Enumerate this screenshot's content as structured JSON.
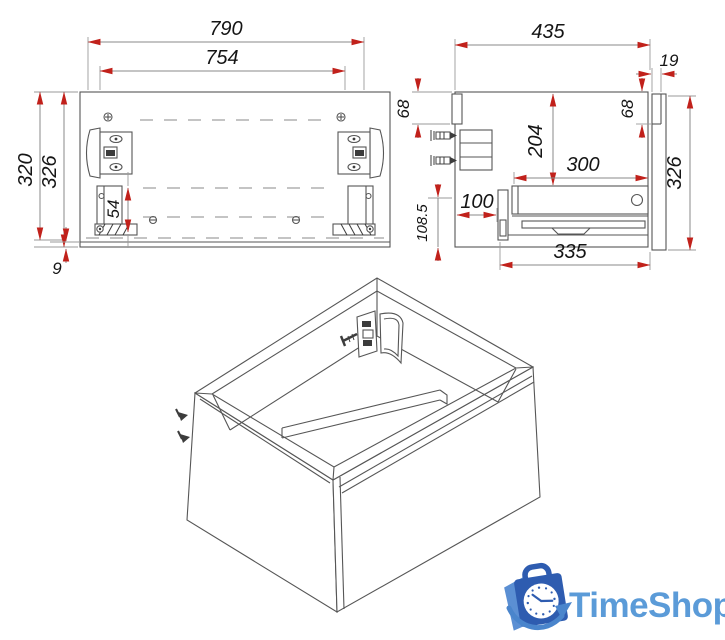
{
  "front_view": {
    "width": "790",
    "opening_width": "754",
    "height_back": "320",
    "height_front": "326",
    "slide_offset": "54",
    "bottom_gap": "9"
  },
  "side_view": {
    "depth": "435",
    "panel_thickness": "19",
    "hanger_left": "68",
    "hanger_right": "68",
    "drawer_top_offset": "204",
    "drawer_length": "300",
    "bracket_offset": "100",
    "bottom_section_height": "108.5",
    "height": "326",
    "bottom_depth": "335"
  },
  "logo": {
    "brand": "TimeShop"
  },
  "colors": {
    "arrow_red": "#c1211b",
    "line_gray": "#565656",
    "logo_bag_blue": "#2e5cb0",
    "logo_flap_blue": "#5b8fd3",
    "logo_swoosh_blue": "#4a85cc",
    "logo_text_blue": "#5b9bd8"
  }
}
